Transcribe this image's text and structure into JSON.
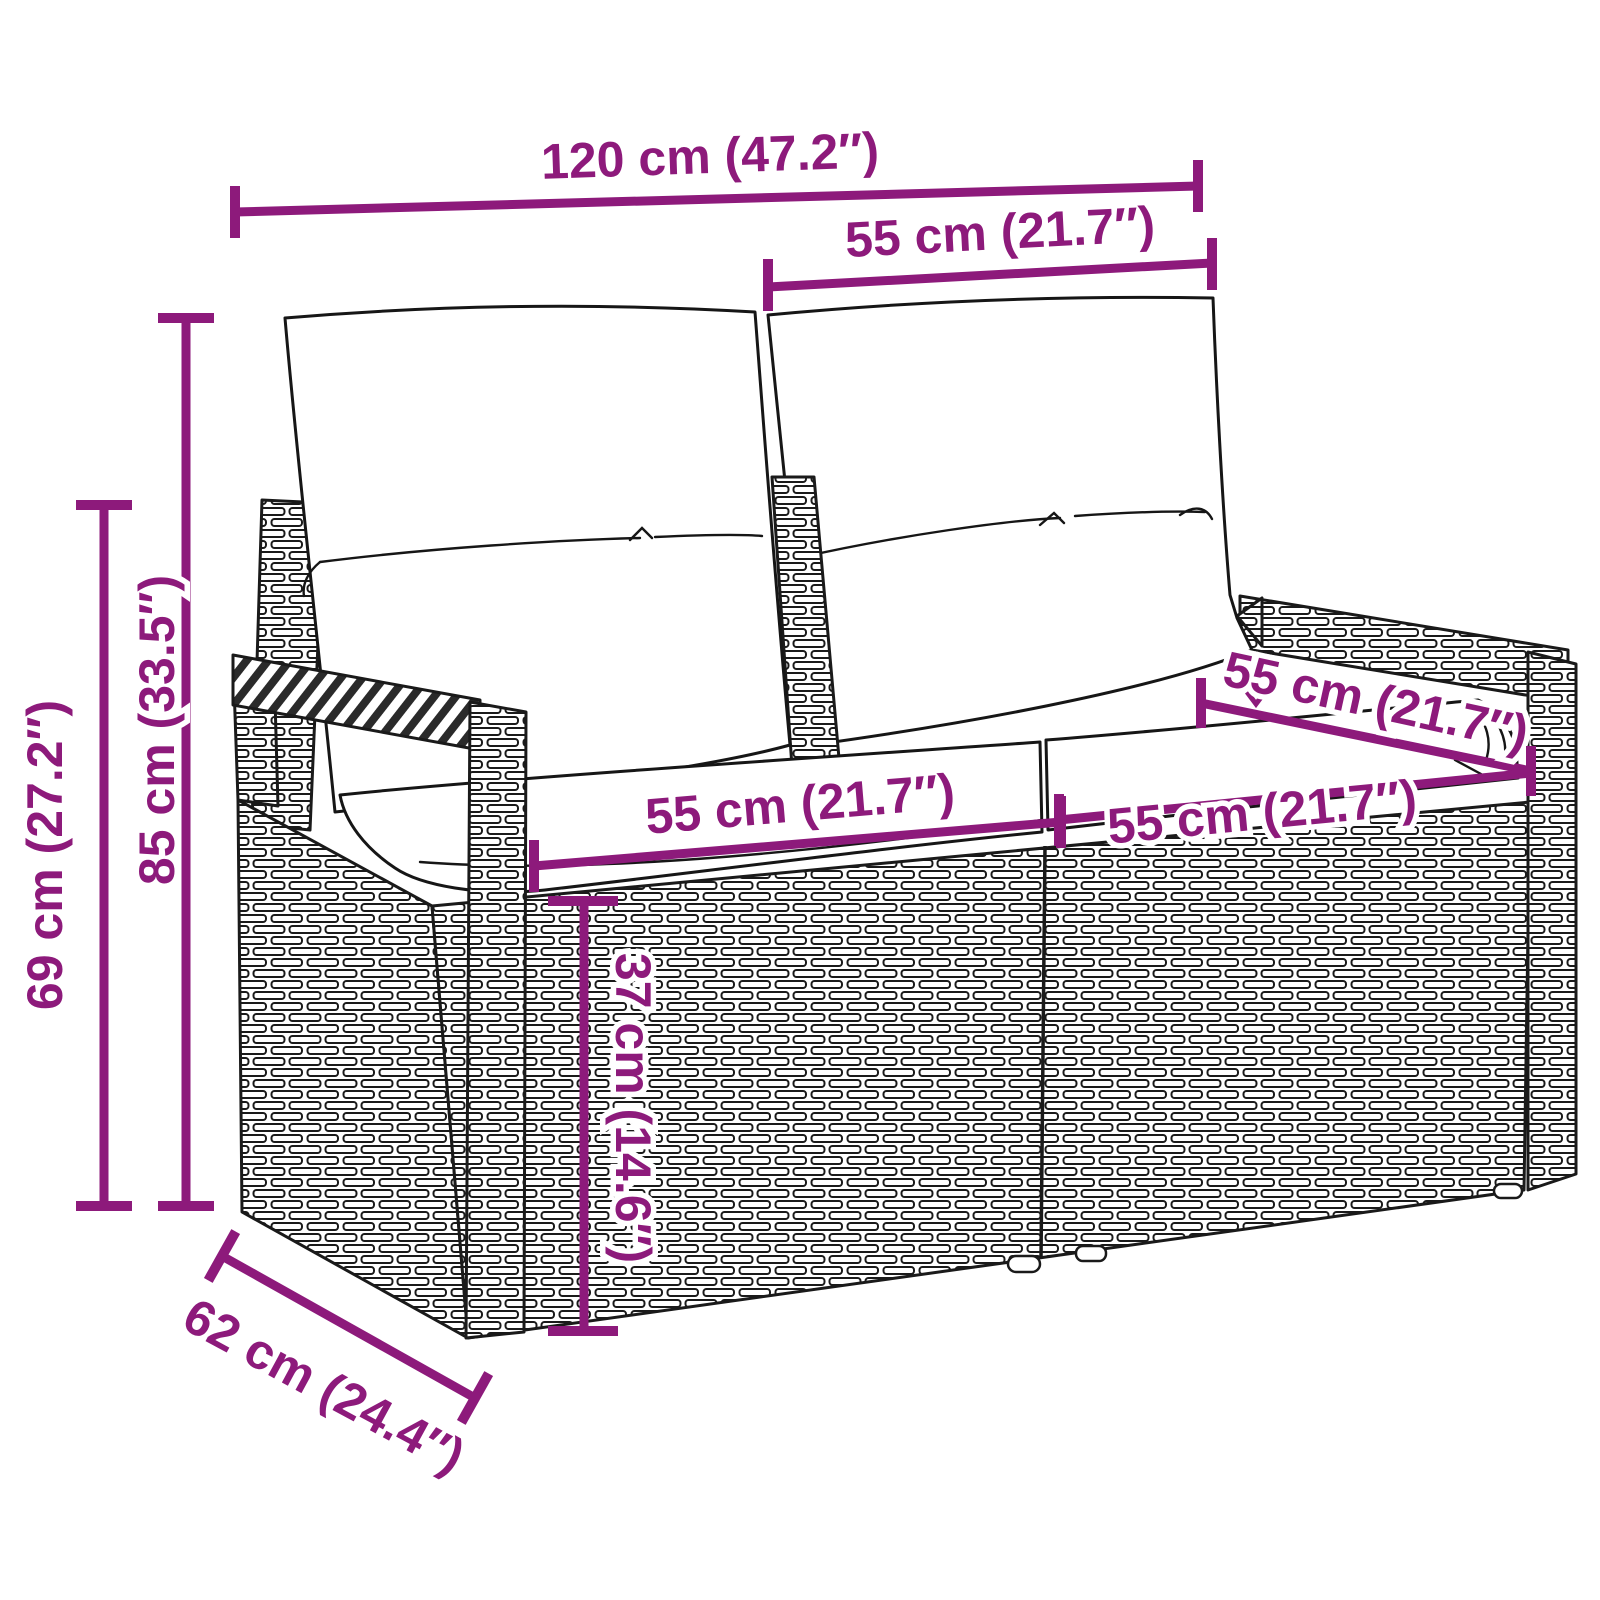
{
  "diagram": {
    "product": "rattan-two-seater-garden-bench-with-cushions",
    "accent_color": "#8d1a7b",
    "ink_color": "#1a1a1a",
    "labels": {
      "overall_width": "120 cm (47.2″)",
      "back_cushion_width": "55 cm (21.7″)",
      "total_height": "85 cm (33.5″)",
      "side_height": "69 cm (27.2″)",
      "seat_width_left": "55 cm (21.7″)",
      "seat_depth": "55 cm (21.7″)",
      "seat_width_right": "55 cm (21.7″)",
      "seat_height": "37 cm (14.6″)",
      "overall_depth": "62 cm (24.4″)"
    }
  }
}
